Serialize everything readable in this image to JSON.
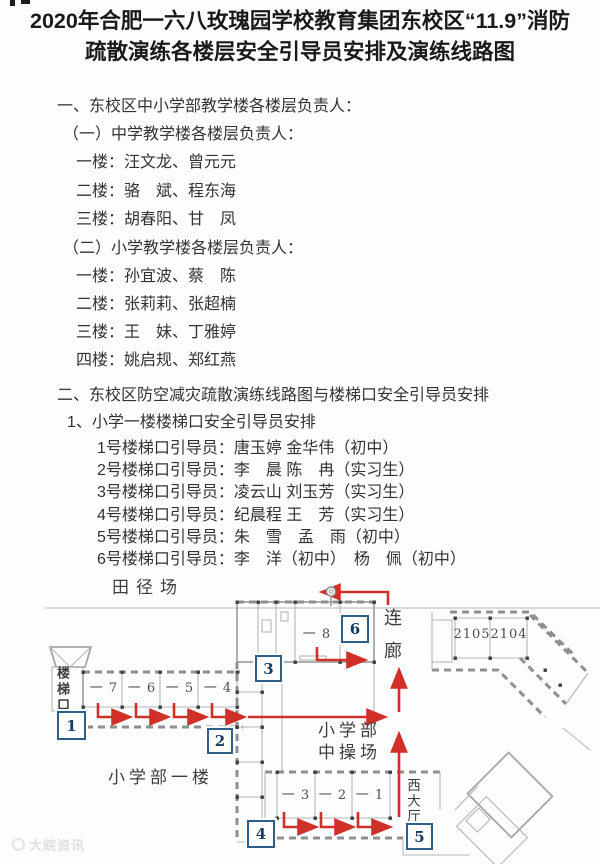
{
  "title": "2020年合肥一六八玫瑰园学校教育集团东校区“11.9”消防疏散演练各楼层安全引导员安排及演练线路图",
  "section_one": {
    "heading": "一、东校区中小学部教学楼各楼层负责人：",
    "groups": [
      {
        "heading": "（一）中学教学楼各楼层负责人：",
        "rows": [
          "一楼：汪文龙、曾元元",
          "二楼：骆　斌、程东海",
          "三楼：胡春阳、甘　凤"
        ]
      },
      {
        "heading": "（二）小学教学楼各楼层负责人：",
        "rows": [
          "一楼：孙宜波、蔡　陈",
          "二楼：张莉莉、张超楠",
          "三楼：王　妹、丁雅婷",
          "四楼：姚启规、郑红燕"
        ]
      }
    ]
  },
  "section_two": {
    "heading": "二、东校区防空减灾疏散演练线路图与楼梯口安全引导员安排",
    "subheading": "1、小学一楼楼梯口安全引导员安排",
    "rows": [
      "1号楼梯口引导员：唐玉婷 金华伟（初中）",
      "2号楼梯口引导员：李　晨 陈　冉（实习生）",
      "3号楼梯口引导员：凌云山 刘玉芳（实习生）",
      "4号楼梯口引导员：纪晨程 王　芳（实习生）",
      "5号楼梯口引导员：朱　雪　孟　雨（初中）",
      "6号楼梯口引导员：李　洋（初中）　杨　佩（初中）"
    ]
  },
  "floor_plan": {
    "labels": {
      "track_field": "田径场",
      "stair_entrance": "楼梯口",
      "corridor": "连廊",
      "primary_first_floor": "小学部一楼",
      "playground_line1": "小学部",
      "playground_line2": "中操场",
      "west_hall": "西大厅"
    },
    "rooms": {
      "west": [
        "一 7",
        "一 6",
        "一 5",
        "一 4"
      ],
      "middle": "一 8",
      "right_top": [
        "2105",
        "2104"
      ],
      "bottom": [
        "一 3",
        "一 2",
        "一 1"
      ]
    },
    "stair_boxes": [
      "1",
      "2",
      "3",
      "4",
      "5",
      "6"
    ],
    "colors": {
      "route_red": "#cf3128",
      "box_blue": "#2e5f8a",
      "wall_gray": "#a6a6a6",
      "title_black": "#1a1a1a",
      "body_text": "#333333"
    }
  },
  "watermark": "大皖资讯"
}
